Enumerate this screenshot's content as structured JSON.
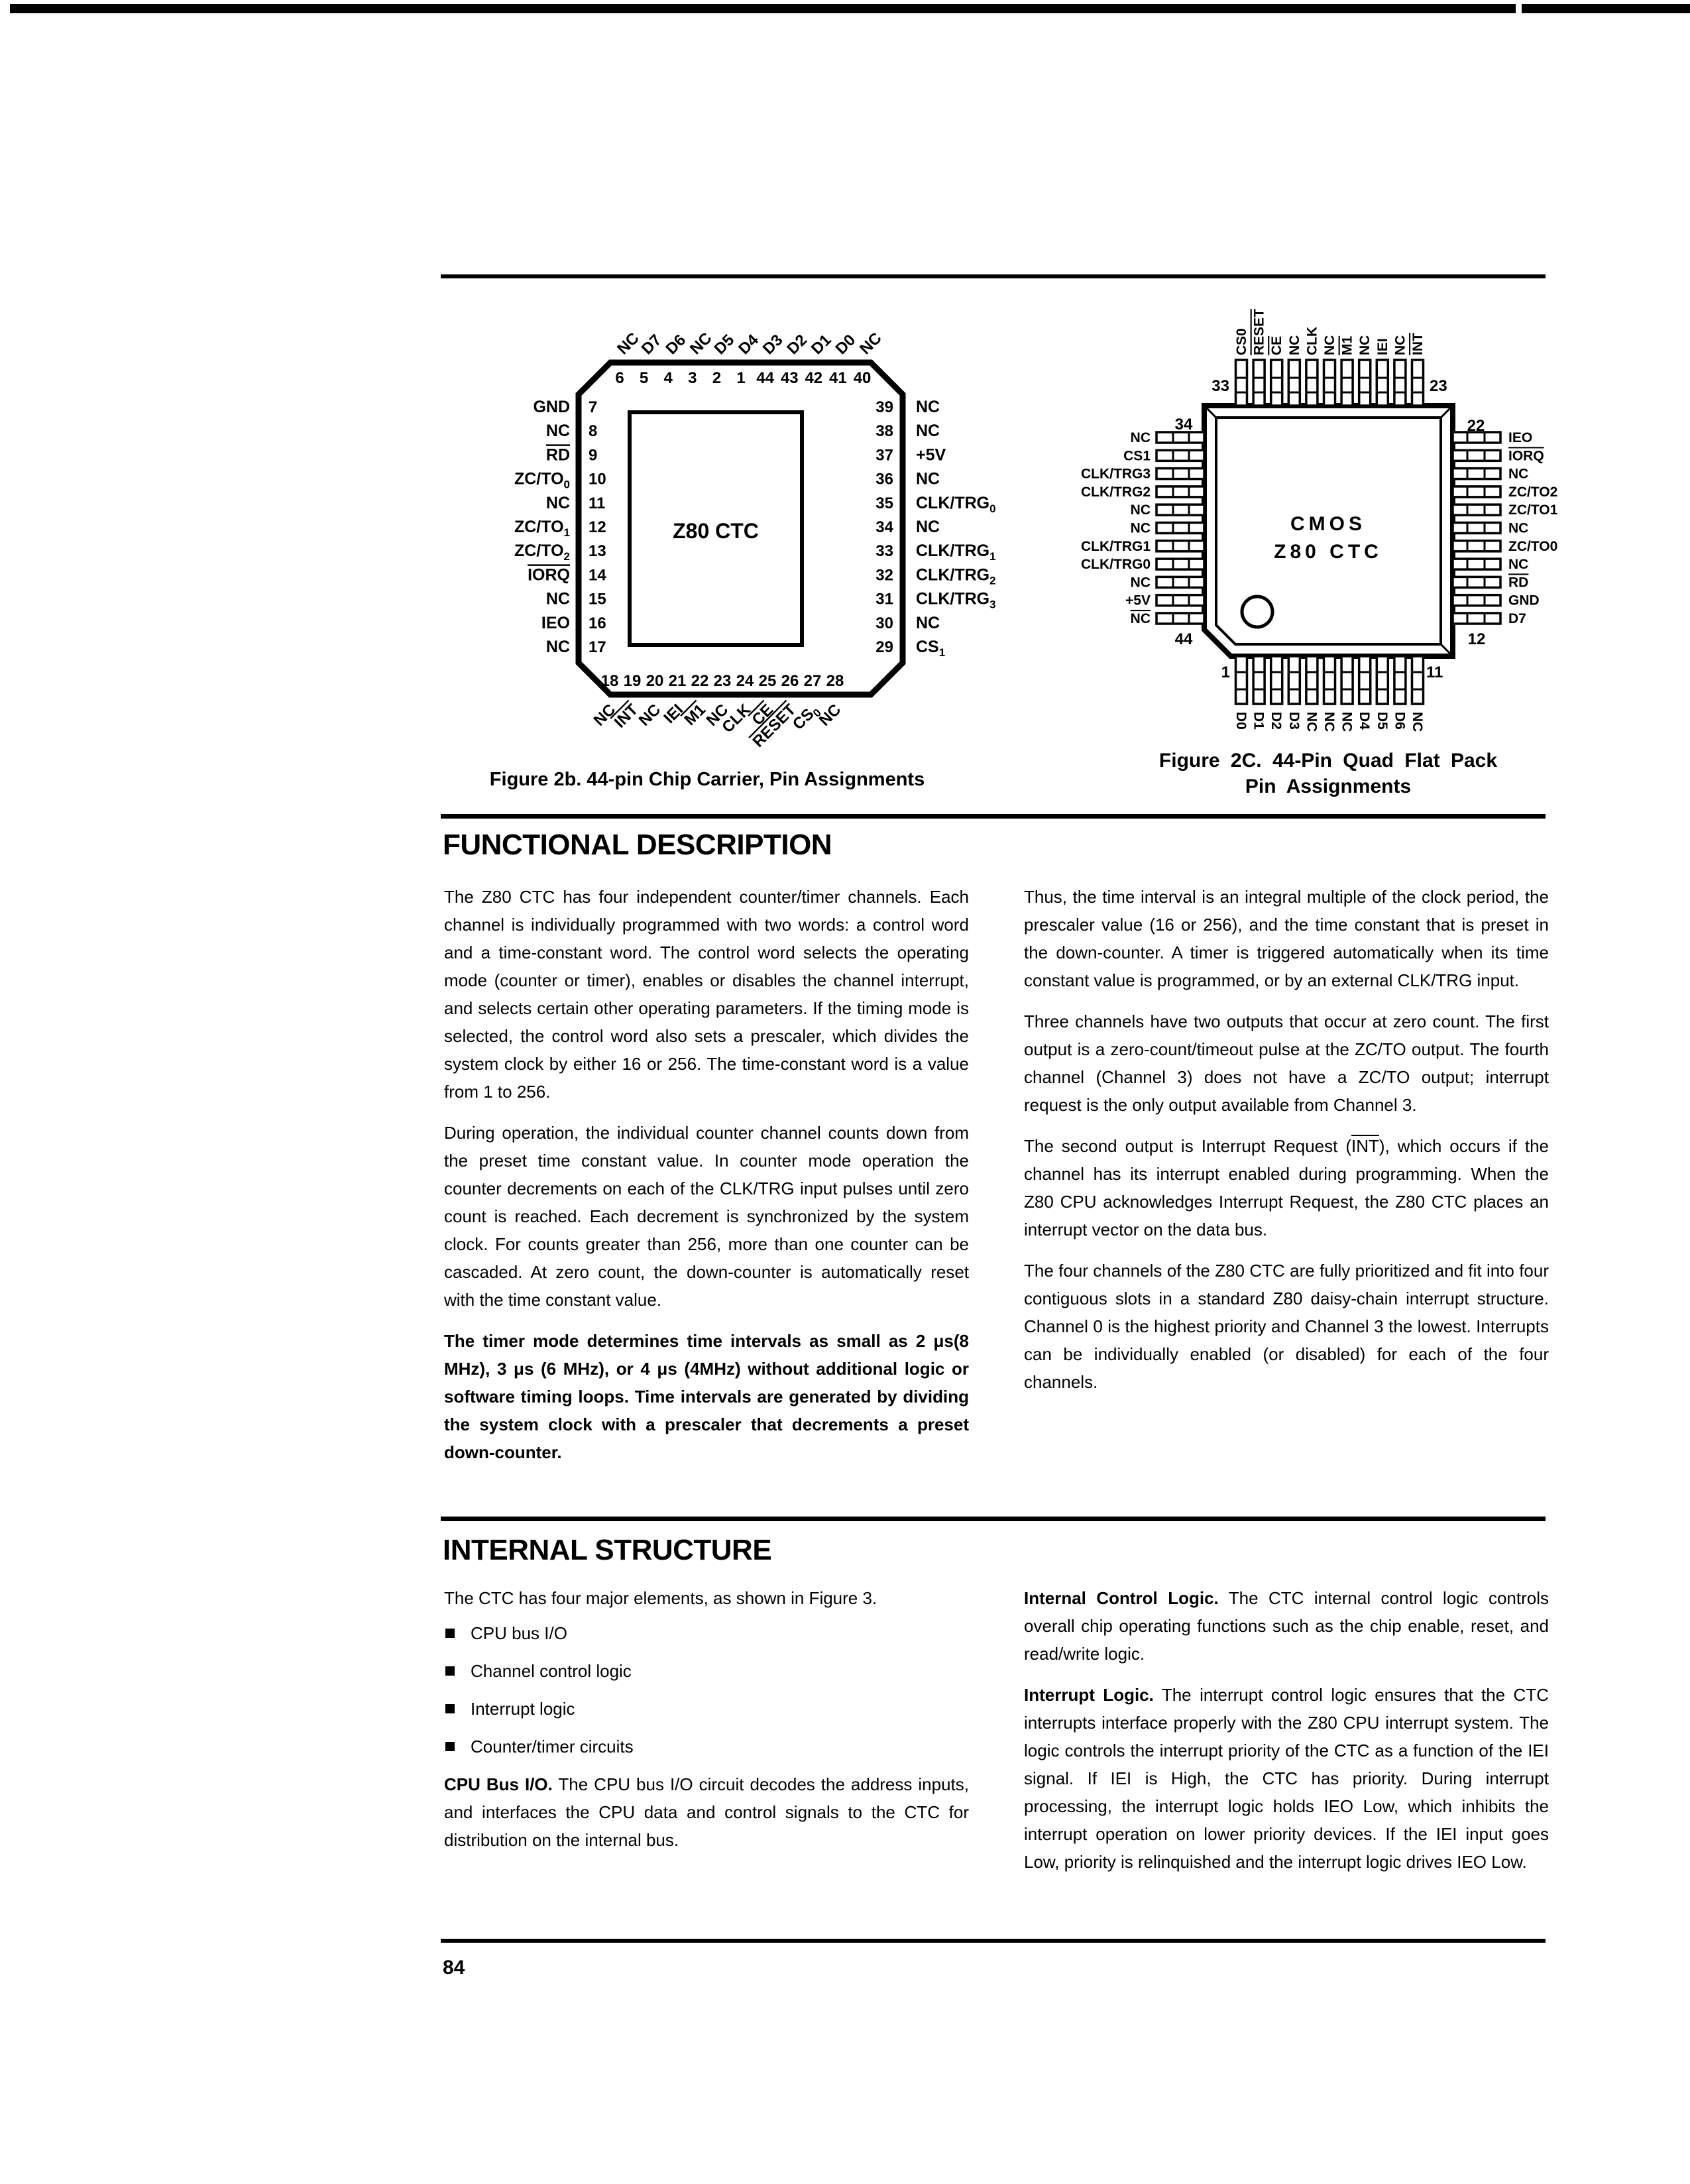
{
  "ink_color": "#000000",
  "page": {
    "number": "84"
  },
  "figures": {
    "fig2b": {
      "caption": "Figure 2b. 44-pin Chip Carrier, Pin Assignments",
      "chip_label": "Z80 CTC",
      "top_numbers": [
        "6",
        "5",
        "4",
        "3",
        "2",
        "1",
        "44",
        "43",
        "42",
        "41",
        "40"
      ],
      "top_labels": [
        {
          "t": "NC"
        },
        {
          "t": "D7"
        },
        {
          "t": "D6"
        },
        {
          "t": "NC"
        },
        {
          "t": "D5"
        },
        {
          "t": "D4"
        },
        {
          "t": "D3"
        },
        {
          "t": "D2"
        },
        {
          "t": "D1"
        },
        {
          "t": "D0"
        },
        {
          "t": "NC"
        }
      ],
      "left_pins": [
        {
          "num": "7",
          "t": "GND"
        },
        {
          "num": "8",
          "t": "NC"
        },
        {
          "num": "9",
          "t": "RD",
          "bar": true
        },
        {
          "num": "10",
          "t": "ZC/TO",
          "sub": "0"
        },
        {
          "num": "11",
          "t": "NC"
        },
        {
          "num": "12",
          "t": "ZC/TO",
          "sub": "1"
        },
        {
          "num": "13",
          "t": "ZC/TO",
          "sub": "2"
        },
        {
          "num": "14",
          "t": "IORQ",
          "bar": true
        },
        {
          "num": "15",
          "t": "NC"
        },
        {
          "num": "16",
          "t": "IEO"
        },
        {
          "num": "17",
          "t": "NC"
        }
      ],
      "right_pins": [
        {
          "num": "39",
          "t": "NC"
        },
        {
          "num": "38",
          "t": "NC"
        },
        {
          "num": "37",
          "t": "+5V"
        },
        {
          "num": "36",
          "t": "NC"
        },
        {
          "num": "35",
          "t": "CLK/TRG",
          "sub": "0"
        },
        {
          "num": "34",
          "t": "NC"
        },
        {
          "num": "33",
          "t": "CLK/TRG",
          "sub": "1"
        },
        {
          "num": "32",
          "t": "CLK/TRG",
          "sub": "2"
        },
        {
          "num": "31",
          "t": "CLK/TRG",
          "sub": "3"
        },
        {
          "num": "30",
          "t": "NC"
        },
        {
          "num": "29",
          "t": "CS",
          "sub": "1"
        }
      ],
      "bottom_numbers": [
        "18",
        "19",
        "20",
        "21",
        "22",
        "23",
        "24",
        "25",
        "26",
        "27",
        "28"
      ],
      "bottom_labels": [
        {
          "t": "NC"
        },
        {
          "t": "INT",
          "bar": true
        },
        {
          "t": "NC"
        },
        {
          "t": "IEI"
        },
        {
          "t": "M1",
          "bar": true
        },
        {
          "t": "NC"
        },
        {
          "t": "CLK"
        },
        {
          "t": "CE",
          "bar": true
        },
        {
          "t": "RESET",
          "bar": true
        },
        {
          "t": "CS",
          "sub": "0"
        },
        {
          "t": "NC"
        }
      ]
    },
    "fig2c": {
      "caption_line1": "Figure 2C. 44-Pin Quad Flat Pack",
      "caption_line2": "Pin Assignments",
      "chip_label_line1": "CMOS",
      "chip_label_line2": "Z80 CTC",
      "corner_numbers": {
        "top_left": "33",
        "top_right": "23",
        "left_top": "34",
        "left_bottom": "44",
        "right_top": "22",
        "right_bottom": "12",
        "bottom_left": "1",
        "bottom_right": "11"
      },
      "top_labels": [
        {
          "t": "CS0"
        },
        {
          "t": "RESET",
          "bar": true
        },
        {
          "t": "CE",
          "bar": true
        },
        {
          "t": "NC"
        },
        {
          "t": "CLK"
        },
        {
          "t": "NC"
        },
        {
          "t": "M1",
          "bar": true
        },
        {
          "t": "NC"
        },
        {
          "t": "IEI"
        },
        {
          "t": "NC"
        },
        {
          "t": "INT",
          "bar": true
        }
      ],
      "left_labels": [
        {
          "t": "NC"
        },
        {
          "t": "CS1"
        },
        {
          "t": "CLK/TRG3"
        },
        {
          "t": "CLK/TRG2"
        },
        {
          "t": "NC"
        },
        {
          "t": "NC"
        },
        {
          "t": "CLK/TRG1"
        },
        {
          "t": "CLK/TRG0"
        },
        {
          "t": "NC"
        },
        {
          "t": "+5V"
        },
        {
          "t": "NC",
          "bar": true
        }
      ],
      "right_labels": [
        {
          "t": "IEO"
        },
        {
          "t": "IORQ",
          "bar": true
        },
        {
          "t": "NC"
        },
        {
          "t": "ZC/TO2"
        },
        {
          "t": "ZC/TO1"
        },
        {
          "t": "NC"
        },
        {
          "t": "ZC/TO0"
        },
        {
          "t": "NC"
        },
        {
          "t": "RD",
          "bar": true
        },
        {
          "t": "GND"
        },
        {
          "t": "D7"
        }
      ],
      "bottom_labels": [
        {
          "t": "D0"
        },
        {
          "t": "D1"
        },
        {
          "t": "D2"
        },
        {
          "t": "D3"
        },
        {
          "t": "NC"
        },
        {
          "t": "NC"
        },
        {
          "t": "NC"
        },
        {
          "t": "D4"
        },
        {
          "t": "D5"
        },
        {
          "t": "D6"
        },
        {
          "t": "NC"
        }
      ]
    }
  },
  "sections": {
    "functional": {
      "heading": "FUNCTIONAL DESCRIPTION",
      "left_paragraphs": [
        [
          {
            "t": "The Z80 CTC has four independent counter/timer channels. Each channel is individually programmed with two words: a control word and a time-constant word. The control word selects the operating mode (counter or timer), enables or disables the channel interrupt, and selects certain other operating parameters. If the timing mode is selected, the control word also sets a prescaler, which divides the system clock by either 16 or 256. The time-constant word is a value from 1 to 256."
          }
        ],
        [
          {
            "t": "During operation, the individual counter channel counts down from the preset time constant value. In counter mode operation the counter decrements on each of the CLK/TRG input pulses until zero count is reached. Each decrement is synchronized by the system clock. For counts greater than 256, more than one counter can be cascaded. At zero count, the down-counter is automatically reset with the time constant value."
          }
        ],
        [
          {
            "t": "The timer mode determines time intervals as small as 2 μs(8 MHz), 3 μs (6 MHz), or 4 μs (4MHz) without additional logic or software timing loops. Time intervals are generated by dividing the system clock with a prescaler that decrements a preset down-counter.",
            "b": true
          }
        ]
      ],
      "right_paragraphs": [
        [
          {
            "t": "Thus, the time interval is an integral multiple of the clock period, the prescaler value (16 or 256), and the time constant that is preset in the down-counter. A timer is triggered automatically when its time constant value is programmed, or by an external CLK/TRG input."
          }
        ],
        [
          {
            "t": "Three channels have two outputs that occur at zero count. The first output is a zero-count/timeout pulse at the ZC/TO output. The fourth channel (Channel 3) does not have a ZC/TO output; interrupt request is the only output available from Channel 3."
          }
        ],
        [
          {
            "t": "The second output is Interrupt Request ("
          },
          {
            "t": "INT",
            "bar": true
          },
          {
            "t": "), which occurs if the channel has its interrupt enabled during programming. When the Z80 CPU acknowledges Interrupt Request, the Z80 CTC places an interrupt vector on the data bus."
          }
        ],
        [
          {
            "t": "The four channels of the Z80 CTC are fully prioritized and fit into four contiguous slots in a standard Z80 daisy-chain interrupt structure. Channel 0 is the highest priority and Channel 3 the lowest. Interrupts can be individually enabled (or disabled) for each of the four channels."
          }
        ]
      ]
    },
    "internal": {
      "heading": "INTERNAL STRUCTURE",
      "intro": "The CTC has four major elements, as shown in Figure 3.",
      "bullets": [
        "CPU bus I/O",
        "Channel control logic",
        "Interrupt logic",
        "Counter/timer circuits"
      ],
      "left_paragraphs": [
        [
          {
            "t": "CPU Bus I/O.",
            "b": true
          },
          {
            "t": " The CPU bus I/O circuit decodes the address inputs, and interfaces the CPU data and control signals to the CTC for distribution on the internal bus."
          }
        ]
      ],
      "right_paragraphs": [
        [
          {
            "t": "Internal Control Logic.",
            "b": true
          },
          {
            "t": " The CTC internal control logic controls overall chip operating functions such as the chip enable, reset, and read/write logic."
          }
        ],
        [
          {
            "t": "Interrupt Logic.",
            "b": true
          },
          {
            "t": " The interrupt control logic ensures that the CTC interrupts interface properly with the Z80 CPU interrupt system. The logic controls the interrupt priority of the CTC as a function of the IEI signal. If IEI is High, the CTC has priority. During interrupt processing, the interrupt logic holds IEO Low, which inhibits the interrupt operation on lower priority devices. If the IEI input goes Low, priority is relinquished and the interrupt logic drives IEO Low."
          }
        ]
      ]
    }
  }
}
